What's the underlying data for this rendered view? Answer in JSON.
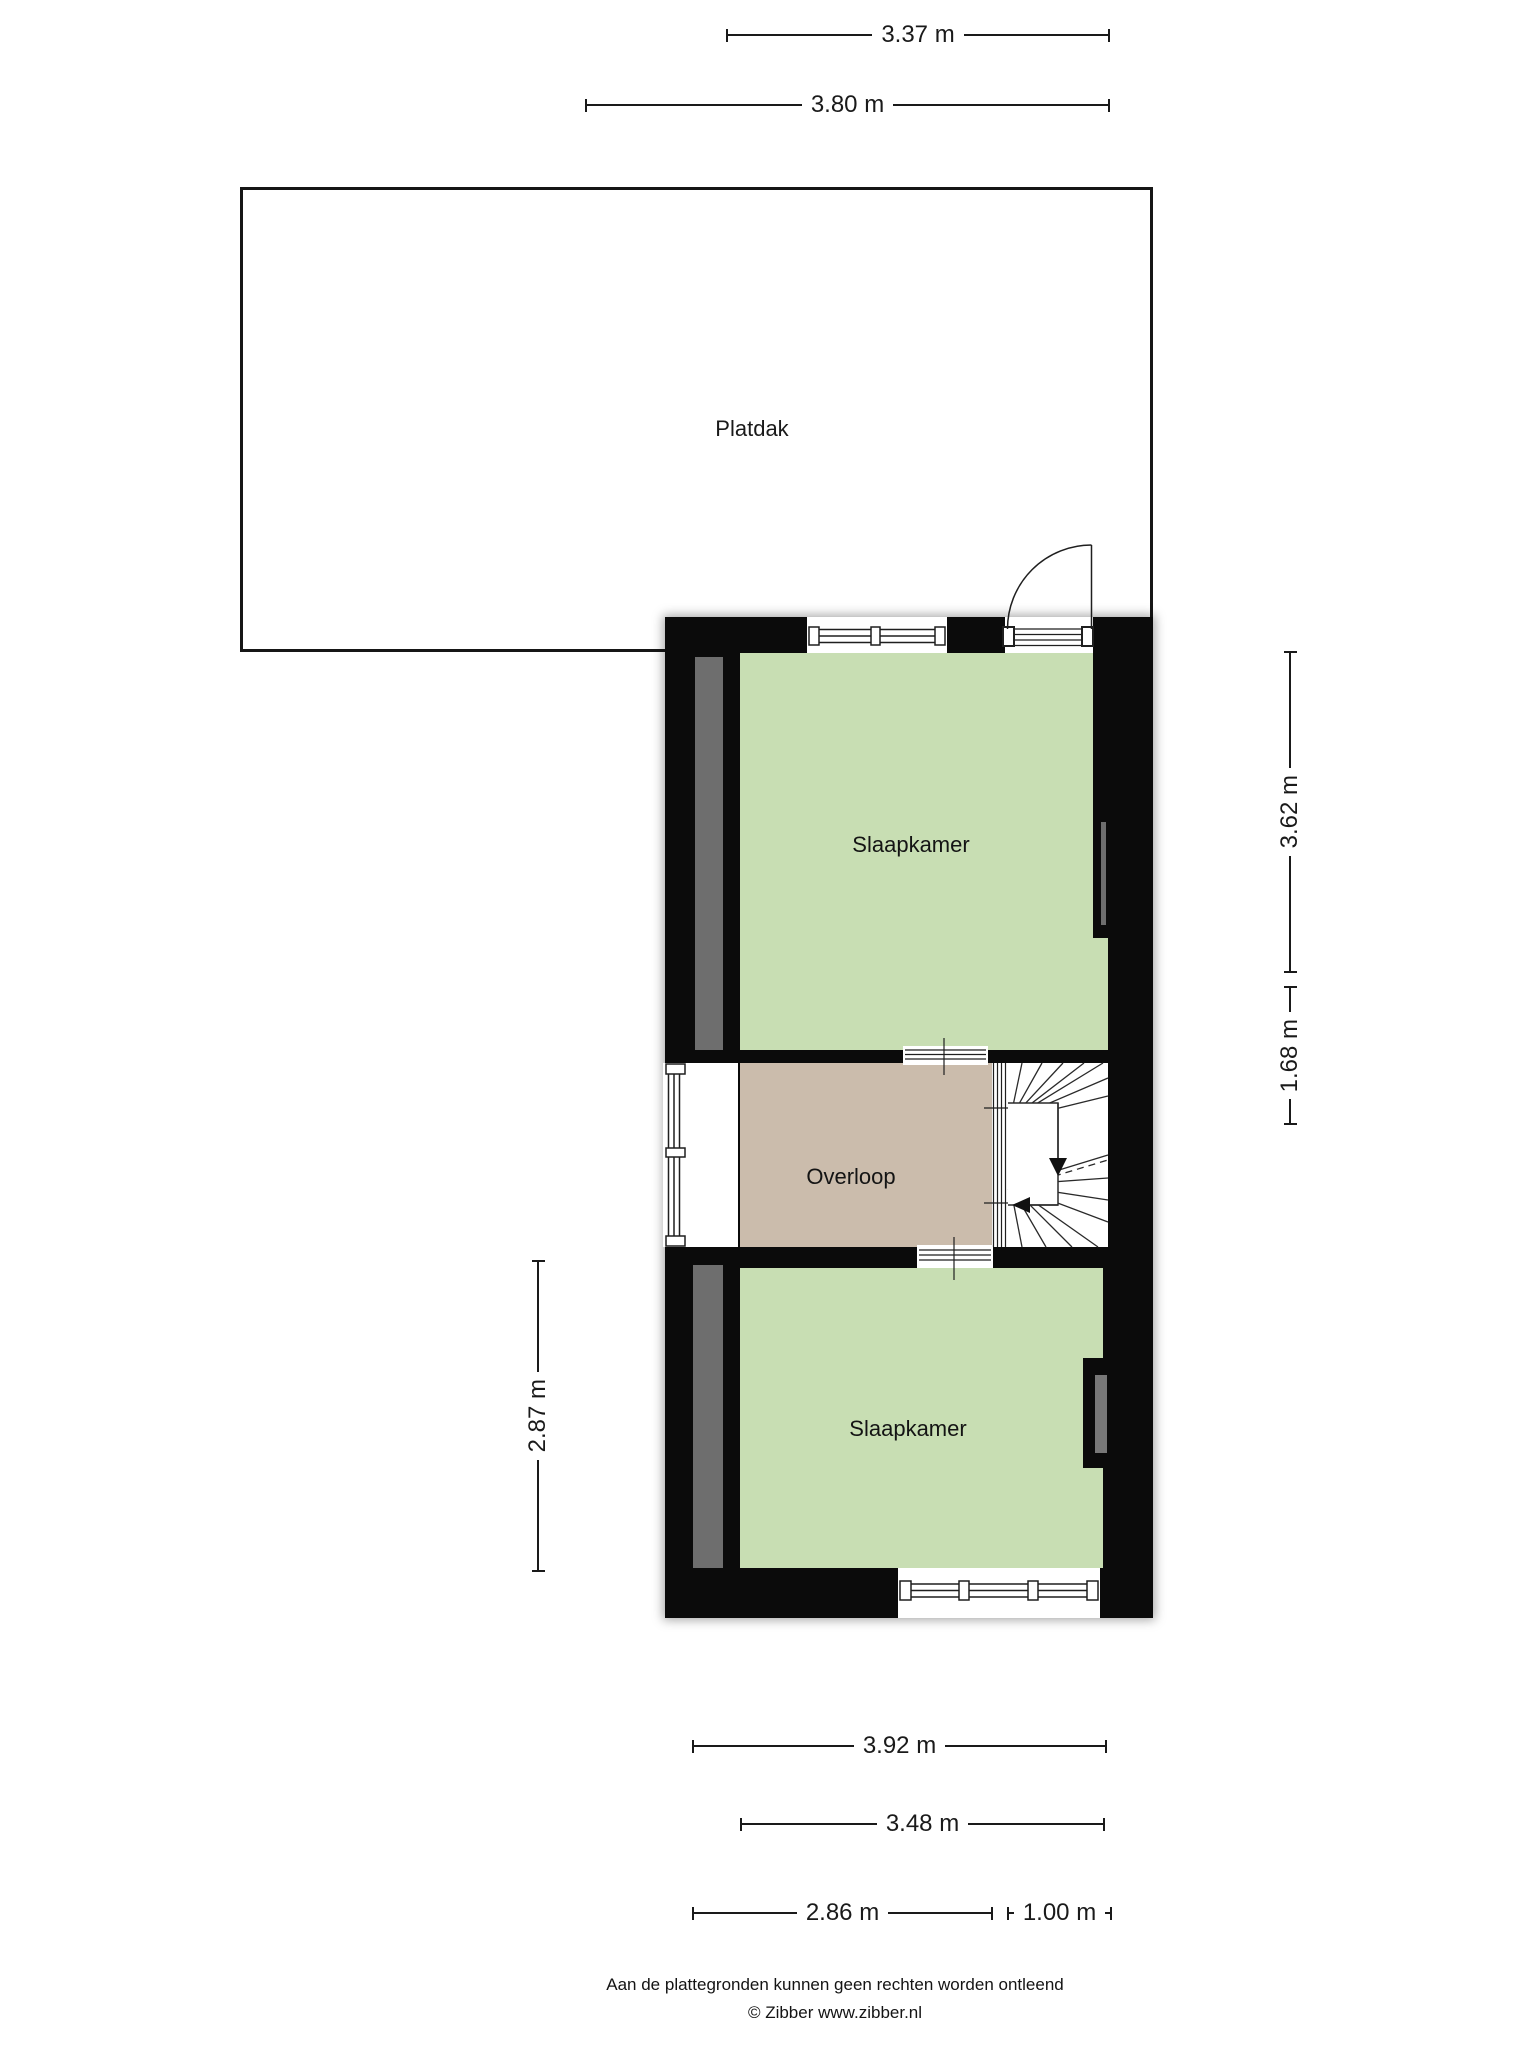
{
  "roof": {
    "label": "Platdak"
  },
  "rooms": [
    {
      "name": "Slaapkamer"
    },
    {
      "name": "Overloop"
    },
    {
      "name": "Slaapkamer"
    }
  ],
  "dimensions": {
    "top": [
      {
        "label": "3.37 m"
      },
      {
        "label": "3.80 m"
      }
    ],
    "right": [
      {
        "label": "3.62 m"
      },
      {
        "label": "1.68 m"
      }
    ],
    "left": [
      {
        "label": "2.87 m"
      }
    ],
    "bottom": [
      {
        "label": "3.92 m"
      },
      {
        "label": "3.48 m"
      },
      {
        "label": "2.86 m"
      },
      {
        "label": "1.00 m"
      }
    ]
  },
  "footer": {
    "disclaimer": "Aan de plattegronden kunnen geen rechten worden ontleend",
    "credit": "© Zibber www.zibber.nl"
  },
  "colors": {
    "wall": "#0b0b0b",
    "bedroom_fill": "#c8deb3",
    "landing_fill": "#cbbcac",
    "wall_accent_gray": "#6e6e6e",
    "dimension_line": "#1a1a1a"
  }
}
